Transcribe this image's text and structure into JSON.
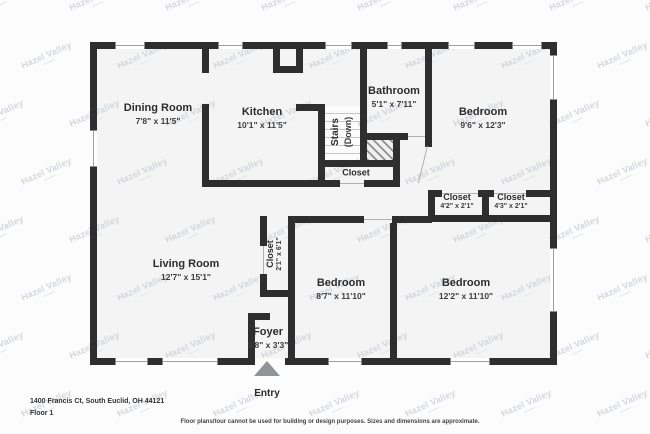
{
  "plan": {
    "watermark": "Hazel Valley",
    "address": "1400 Francis Ct, South Euclid, OH 44121",
    "floor_label": "Floor 1",
    "disclaimer": "Floor plans/tour cannot be used for building or design purposes. Sizes and dimensions are approximate.",
    "entry_label": "Entry",
    "colors": {
      "wall": "#2e2e2e",
      "floor": "#f4f4f4",
      "page": "#fcfcfc",
      "watermark": "#ccd1d7"
    },
    "rooms": [
      {
        "key": "dining-room",
        "name": "Dining Room",
        "dims": "7'8\" x 11'5\"",
        "cx": 158,
        "cy": 114,
        "rot": 0,
        "small": false
      },
      {
        "key": "kitchen",
        "name": "Kitchen",
        "dims": "10'1\" x 11'5\"",
        "cx": 262,
        "cy": 118,
        "rot": 0,
        "small": false
      },
      {
        "key": "bathroom",
        "name": "Bathroom",
        "dims": "5'1\" x 7'11\"",
        "cx": 394,
        "cy": 97,
        "rot": 0,
        "small": false
      },
      {
        "key": "bedroom-top-right",
        "name": "Bedroom",
        "dims": "9'6\" x 12'3\"",
        "cx": 483,
        "cy": 118,
        "rot": 0,
        "small": false
      },
      {
        "key": "stairs",
        "name": "Stairs",
        "dims": "(Down)",
        "cx": 342,
        "cy": 132,
        "rot": -90,
        "small": false
      },
      {
        "key": "closet-under-stairs",
        "name": "Closet",
        "dims": "",
        "cx": 356,
        "cy": 173,
        "rot": 0,
        "small": true
      },
      {
        "key": "closet-hall-left",
        "name": "Closet",
        "dims": "4'2\" x 2'1\"",
        "cx": 457,
        "cy": 202,
        "rot": 0,
        "small": true
      },
      {
        "key": "closet-hall-right",
        "name": "Closet",
        "dims": "4'3\" x 2'1\"",
        "cx": 511,
        "cy": 202,
        "rot": 0,
        "small": true
      },
      {
        "key": "living-room",
        "name": "Living Room",
        "dims": "12'7\" x 15'1\"",
        "cx": 186,
        "cy": 270,
        "rot": 0,
        "small": false
      },
      {
        "key": "closet-living",
        "name": "Closet",
        "dims": "2'1\" x 6'1\"",
        "cx": 275,
        "cy": 254,
        "rot": -90,
        "small": true
      },
      {
        "key": "bedroom-middle",
        "name": "Bedroom",
        "dims": "8'7\" x 11'10\"",
        "cx": 341,
        "cy": 289,
        "rot": 0,
        "small": false
      },
      {
        "key": "bedroom-bottom-right",
        "name": "Bedroom",
        "dims": "12'2\" x 11'10\"",
        "cx": 466,
        "cy": 289,
        "rot": 0,
        "small": false
      },
      {
        "key": "foyer",
        "name": "Foyer",
        "dims": "3'8\" x 3'3\"",
        "cx": 268,
        "cy": 338,
        "rot": 0,
        "small": false
      }
    ]
  }
}
